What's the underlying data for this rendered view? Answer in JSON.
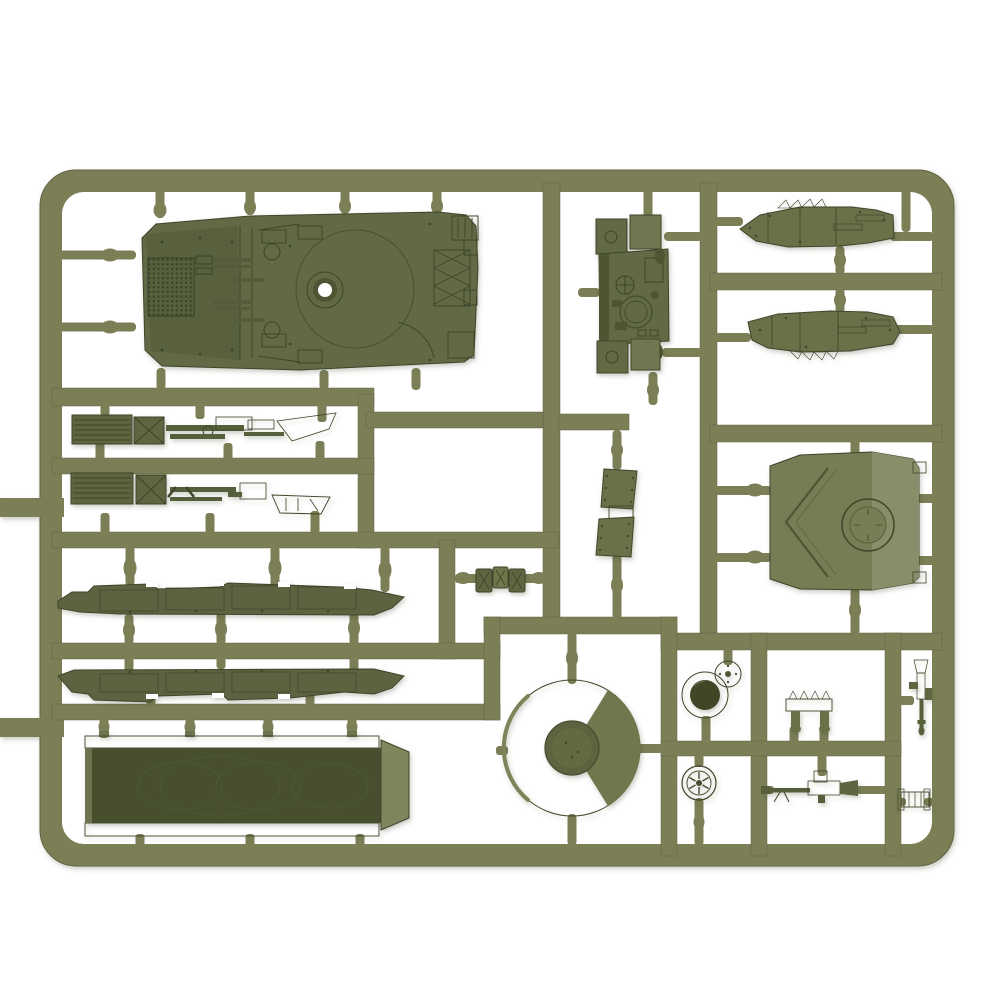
{
  "meta": {
    "alt": "Olive drab plastic model kit sprue with tank parts on a white background",
    "subject": "injection-molded sprue of a miniature tank model kit"
  },
  "colors": {
    "bg": "#ffffff",
    "rail": "#7b7e57",
    "railEdge": "#5f6240",
    "detail": "#3e4429",
    "olive": "#626a44",
    "oliveDark": "#4d5433",
    "oliveLight": "#7c8158",
    "greyGreen": "#898d6a",
    "toolDark": "#5e6540",
    "binDark": "#464f2e",
    "hole": "#ffffff"
  },
  "parts": {
    "hull": {
      "label": "Tank hull upper deck with engine grille and turret ring"
    },
    "fightingCompartment": {
      "label": "Fighting compartment interior assembly"
    },
    "fenderUpper": {
      "label": "Right fender / track guard (upper)"
    },
    "fenderLower": {
      "label": "Right fender / track guard (lower)"
    },
    "toolRow1": {
      "label": "Stowage strip with radiator box and tools (upper)"
    },
    "toolRow2": {
      "label": "Stowage strip with radiator box and tools (lower)"
    },
    "skirtUpper": {
      "label": "Side skirt / track piece (upper)"
    },
    "skirtLower": {
      "label": "Side skirt / track piece (lower)"
    },
    "bin": {
      "label": "Open stowage bin / hull tub"
    },
    "mudflap": {
      "label": "Riveted mud flap pair"
    },
    "platelets": {
      "label": "Three small hatch plates"
    },
    "turretRoof": {
      "label": "Turret top plate with round hatch"
    },
    "baseRing": {
      "label": "Round turret base with hub"
    },
    "cupCover": {
      "label": "Cup-shaped hatch drum"
    },
    "discCap": {
      "label": "Small disc cap"
    },
    "roadWheel": {
      "label": "Spoked road wheel"
    },
    "rack": {
      "label": "Small toothed rack bracket"
    },
    "machineGun": {
      "label": "Machine gun"
    },
    "verticalGun": {
      "label": "Machine gun (vertical)"
    },
    "roller": {
      "label": "Flanged roller / muffler"
    }
  },
  "sprue": {
    "frame_label": "Sprue runner frame",
    "gate_label": "Sprue gate peg"
  }
}
